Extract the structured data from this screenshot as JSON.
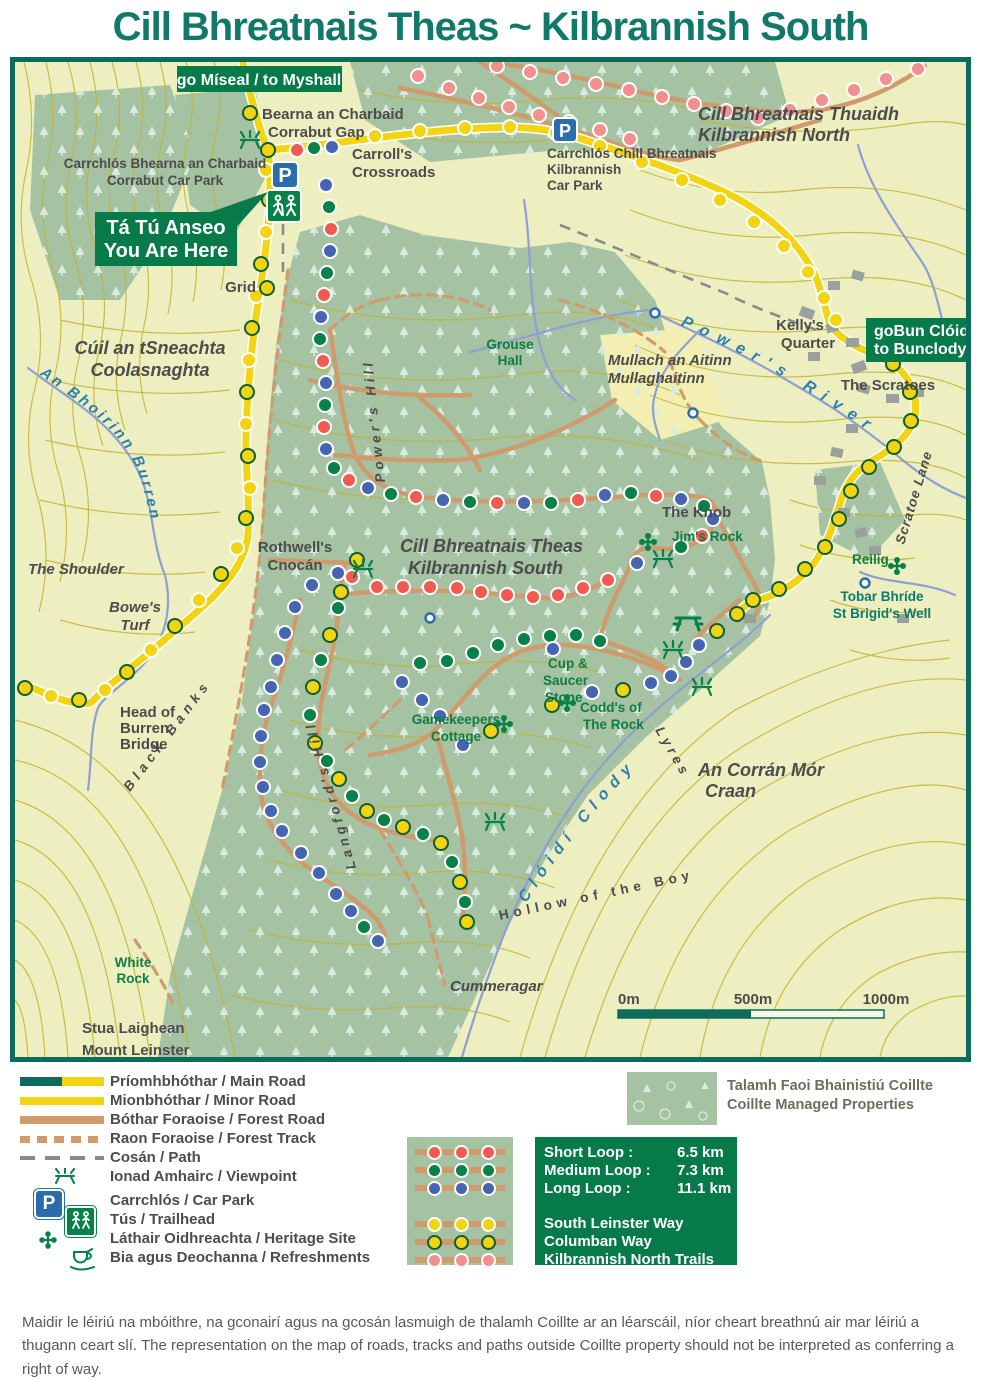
{
  "title": "Cill Bhreatnais Theas ~ Kilbrannish South",
  "colors": {
    "title_teal": "#12796a",
    "map_border": "#0c6b5a",
    "map_background": "#edefc0",
    "contour_olive": "#c2b52f",
    "forest_green": "#a5c2a3",
    "road_yellow": "#f2d413",
    "forest_road_tan": "#cf9b6c",
    "river_blue": "#8e9fd2",
    "sign_green": "#077a4a",
    "short_loop_red": "#f05a50",
    "medium_loop_green": "#068148",
    "long_loop_blue": "#4565b3",
    "south_leinster_yellow": "#f2d413",
    "kilbrannish_north_pink": "#f29090",
    "parking_blue": "#2b6cad"
  },
  "signs": {
    "to_myshall": "go Míseal / to Myshall",
    "to_bunclody": [
      "goBun Clóidí",
      "to Bunclody"
    ],
    "you_are_here": [
      "Tá Tú Anseo",
      "You Are Here"
    ]
  },
  "icons": {
    "parking_letter": "P"
  },
  "labels": {
    "bearna": [
      "Bearna an Charbaid",
      "Corrabut Gap"
    ],
    "corrabut_carpark": [
      "Carrchlós Bhearna an Charbaid",
      "Corrabut Car Park"
    ],
    "carrolls": [
      "Carroll's",
      "Crossroads"
    ],
    "kilbrannish_carpark": [
      "Carrchlós Chill Bhreatnais",
      "Kilbrannish",
      "Car Park"
    ],
    "kilbrannish_north": [
      "Cill Bhreatnais Thuaidh",
      "Kilbrannish North"
    ],
    "kellys_quarter": [
      "Kelly's",
      "Quarter"
    ],
    "scratoes": "The Scratoes",
    "coolasnaghta": [
      "Cúil an tSneachta",
      "Coolasnaghta"
    ],
    "burren_river": "An Bhoirinn Burren",
    "grouse_hall": [
      "Grouse",
      "Hall"
    ],
    "mullaghaitinn": [
      "Mullach an Aitinn",
      "Mullaghaitinn"
    ],
    "grid": "Grid",
    "powers_river": "Power's River",
    "powers_hill": "Power's Hill",
    "scratoe_lane": "Scratoe Lane",
    "the_knob": "The Knob",
    "jims_rock": "Jim's Rock",
    "rothwells": [
      "Rothwell's",
      "Cnocán"
    ],
    "kilbrannish_south": [
      "Cill Bhreatnais Theas",
      "Kilbrannish South"
    ],
    "reilig": "Reilig",
    "st_brigids": [
      "Tobar Bhríde",
      "St Brigid's Well"
    ],
    "the_shoulder": "The Shoulder",
    "bowes_turf": [
      "Bowe's",
      "Turf"
    ],
    "head_of_burren": [
      "Head of",
      "Burren",
      "Bridge"
    ],
    "cup_saucer": [
      "Cup &",
      "Saucer",
      "Stone"
    ],
    "codds": [
      "Codd's of",
      "The Rock"
    ],
    "gamekeepers": [
      "Gamekeepers",
      "Cottage"
    ],
    "corran_mor": [
      "An Corrán Mór",
      "Craan"
    ],
    "clody_river": "Clóidí Clody",
    "lyres": "Lyres",
    "hollow_boy": "Hollow of the Boy",
    "black_banks": "Black Banks",
    "langfords_hill": "Langford's Hill",
    "white_rock": [
      "White",
      "Rock"
    ],
    "cummeragar": "Cummeragar",
    "mount_leinster": [
      "Stua Laighean",
      "Mount Leinster"
    ]
  },
  "scalebar": {
    "zero": "0m",
    "mid": "500m",
    "end": "1000m"
  },
  "legend": {
    "main_road": "Príomhbhóthar / Main Road",
    "minor_road": "Mionbhóthar / Minor Road",
    "forest_road": "Bóthar Foraoise / Forest Road",
    "forest_track": "Raon Foraoise / Forest Track",
    "path": "Cosán / Path",
    "viewpoint": "Ionad Amhairc / Viewpoint",
    "car_park": "Carrchlós / Car Park",
    "trailhead": "Tús / Trailhead",
    "heritage": "Láthair Oidhreachta / Heritage Site",
    "refreshments": "Bia agus Deochanna / Refreshments"
  },
  "managed": [
    "Talamh Faoi Bhainistiú Coillte",
    "Coillte Managed Properties"
  ],
  "loops": {
    "rows": [
      {
        "name": "Short Loop :",
        "dist": "6.5 km"
      },
      {
        "name": "Medium Loop :",
        "dist": "7.3 km"
      },
      {
        "name": "Long Loop :",
        "dist": "11.1 km"
      }
    ],
    "ways": [
      "South Leinster Way",
      "Columban Way",
      "Kilbrannish North Trails"
    ]
  },
  "disclaimer": "Maidir le léiriú na mbóithre, na gconairí agus na gcosán lasmuigh de thalamh Coillte ar an léarscáil, níor cheart breathnú air mar léiriú a thugann ceart slí. The representation on the map of roads, tracks and paths outside Coillte property should not be interpreted as conferring a right of way."
}
